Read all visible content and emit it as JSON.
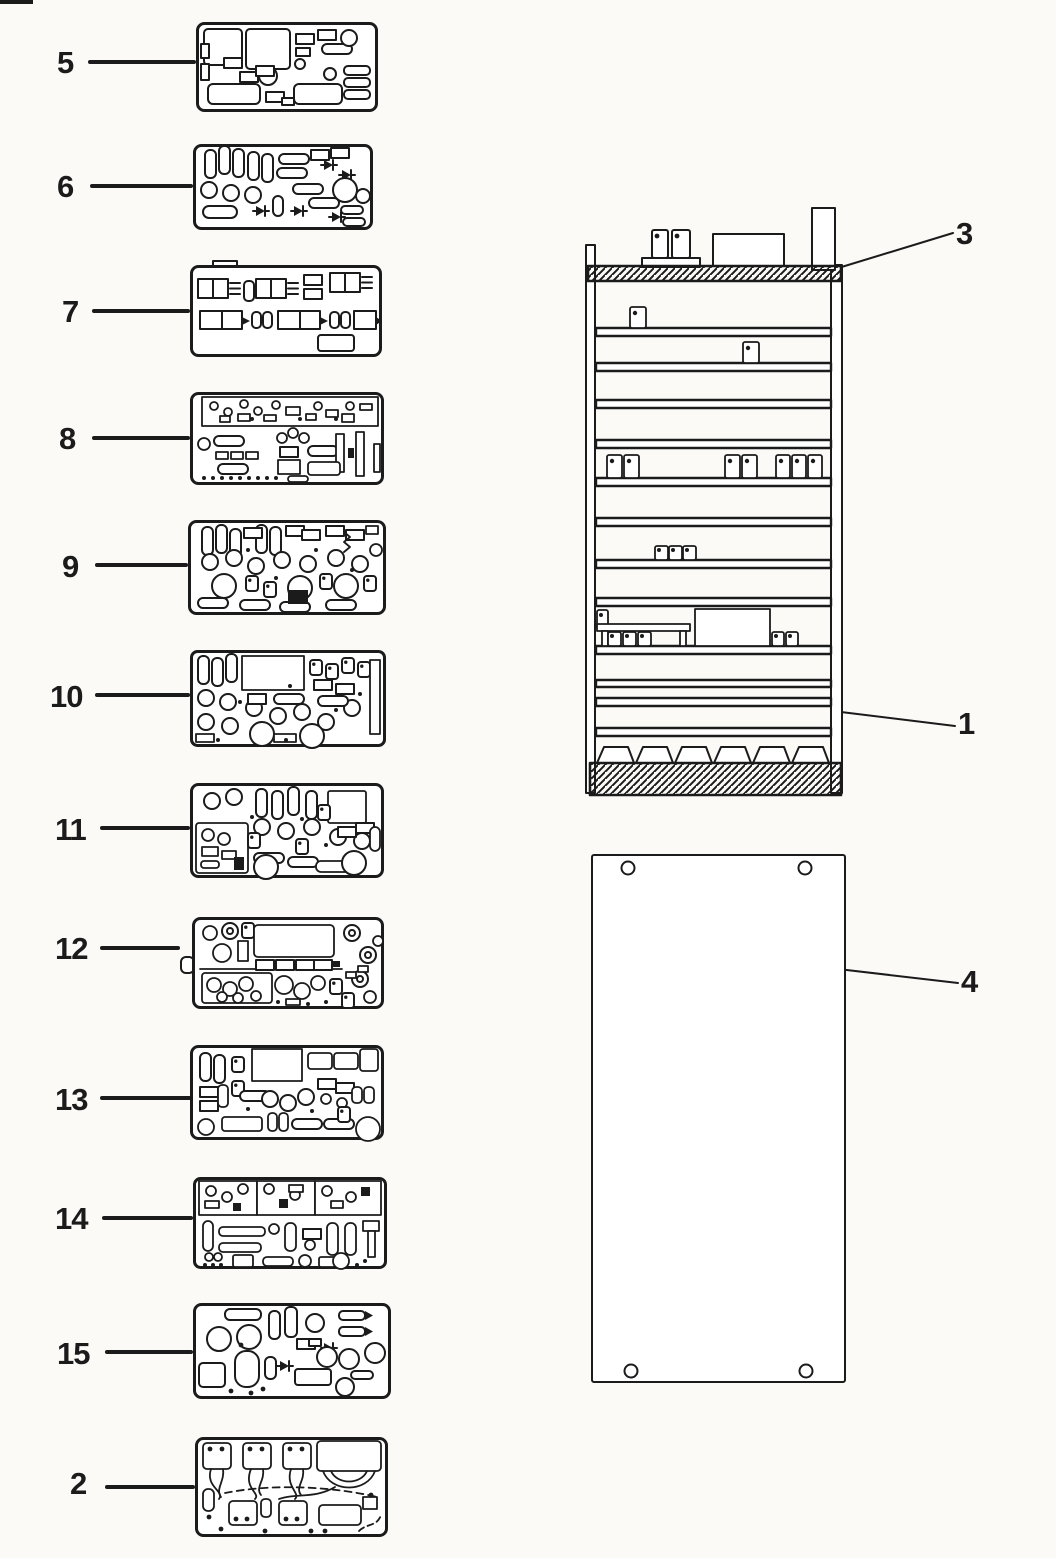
{
  "colors": {
    "ink": "#1b1b1b",
    "paper": "#fbfaf7"
  },
  "callouts": {
    "c5": {
      "label": "5"
    },
    "c6": {
      "label": "6"
    },
    "c7": {
      "label": "7"
    },
    "c8": {
      "label": "8"
    },
    "c9": {
      "label": "9"
    },
    "c10": {
      "label": "10"
    },
    "c11": {
      "label": "11"
    },
    "c12": {
      "label": "12"
    },
    "c13": {
      "label": "13"
    },
    "c14": {
      "label": "14"
    },
    "c15": {
      "label": "15"
    },
    "c2": {
      "label": "2"
    },
    "c3": {
      "label": "3"
    },
    "c1": {
      "label": "1"
    },
    "c4": {
      "label": "4"
    }
  }
}
